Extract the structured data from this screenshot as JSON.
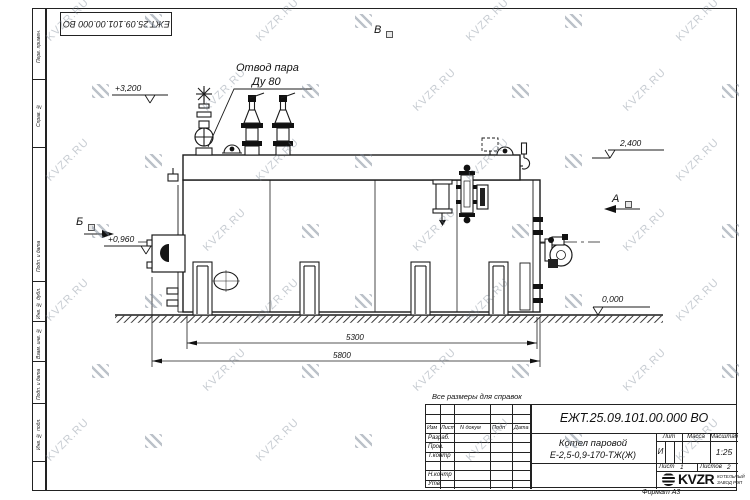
{
  "watermark": {
    "text": "KVZR.RU",
    "icon": "kvzr-logo-hatch-icon"
  },
  "corner_stamp": {
    "designation": "ЕЖТ.25.09.101.00.000 ВО"
  },
  "margin_labels": {
    "perv_primen": "Перв. примен.",
    "sprav_no": "Справ. №",
    "podp_data_1": "Подп. и дата",
    "inv_dubl": "Инв. № дубл.",
    "vzam_inv": "Взам. инв. №",
    "podp_data_2": "Подп. и дата",
    "inv_podl": "Инв. № подл."
  },
  "drawing": {
    "callout": {
      "line1": "Отвод пара",
      "line2": "Ду 80"
    },
    "elevations": {
      "top": "+3,200",
      "right": "2,400",
      "mid_left": "+0,960",
      "ground": "0,000"
    },
    "view_labels": {
      "a": "А",
      "b": "Б",
      "v": "В"
    },
    "dimensions": {
      "length_inner": "5300",
      "length_overall": "5800"
    }
  },
  "note": "Все размеры для справок",
  "title_block": {
    "designation": "ЕЖТ.25.09.101.00.000  ВО",
    "name_line1": "Котел паровой",
    "name_line2": "Е-2,5-0,9-170-ТЖ(Ж)",
    "cols": {
      "izm": "Изм",
      "list": "Лист",
      "n_dokum": "N докум",
      "podp": "Подп",
      "data": "Дата"
    },
    "rows": {
      "razrab": "Разраб.",
      "prov": "Пров.",
      "tkontr": "Т.контр",
      "nkontr": "Н.контр",
      "utv": "Утв."
    },
    "lit_label": "Лит",
    "lit_value": "И",
    "mass_label": "Масса",
    "scale_label": "Масштаб",
    "scale_value": "1:25",
    "sheet_label": "Лист",
    "sheet_value": "1",
    "sheets_label": "Листов",
    "sheets_value": "2",
    "company_logo": "KVZR",
    "company_sub1": "КОТЕЛЬНЫЙ",
    "company_sub2": "ЗАВОД РЭП",
    "format_label": "Формат А3"
  }
}
